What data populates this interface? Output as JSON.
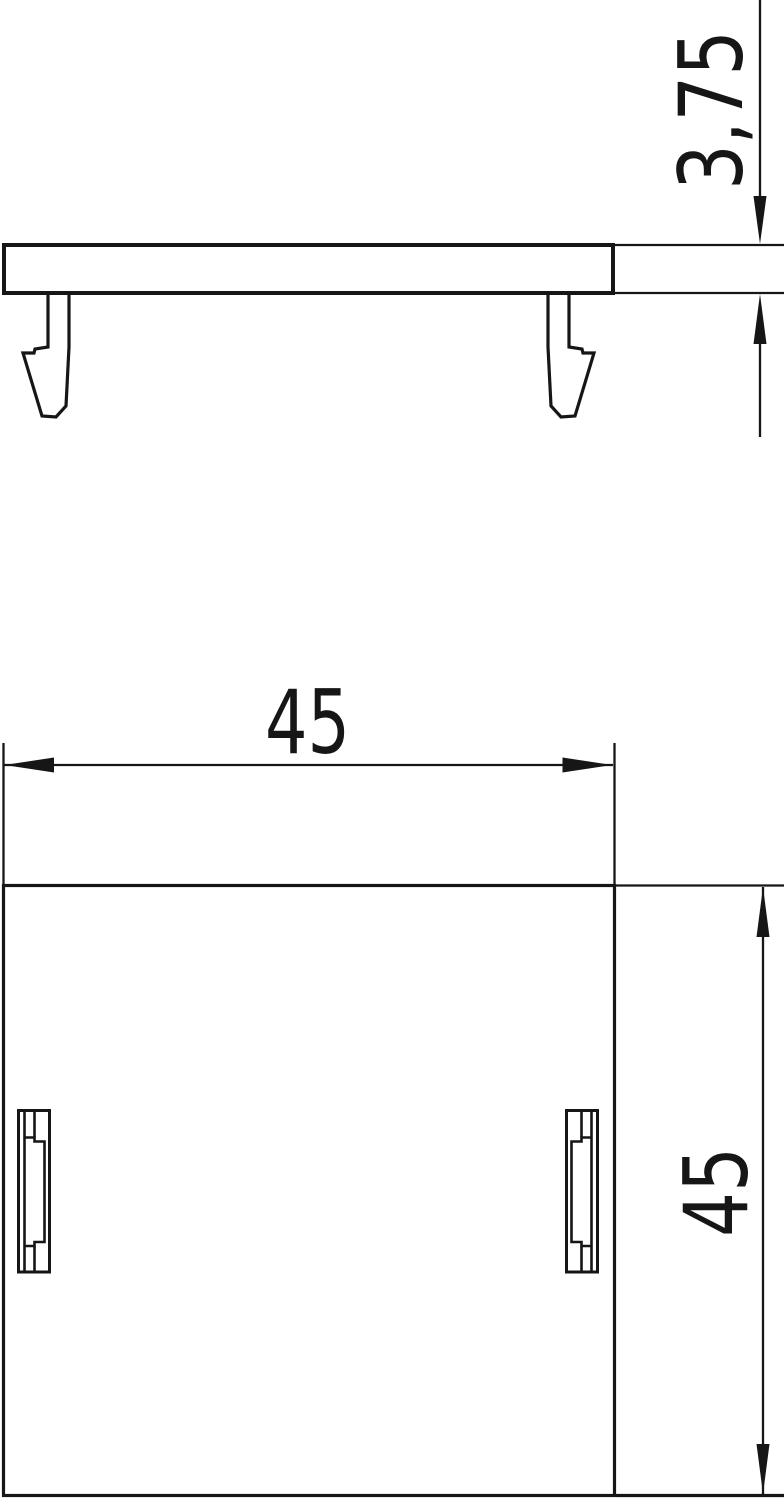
{
  "meta": {
    "background_color": "#ffffff",
    "line_color": "#161616"
  },
  "drawing": {
    "side_view": {
      "thickness_dimension_label": "3,75"
    },
    "front_view": {
      "width_dimension_label": "45",
      "height_dimension_label": "45"
    }
  }
}
